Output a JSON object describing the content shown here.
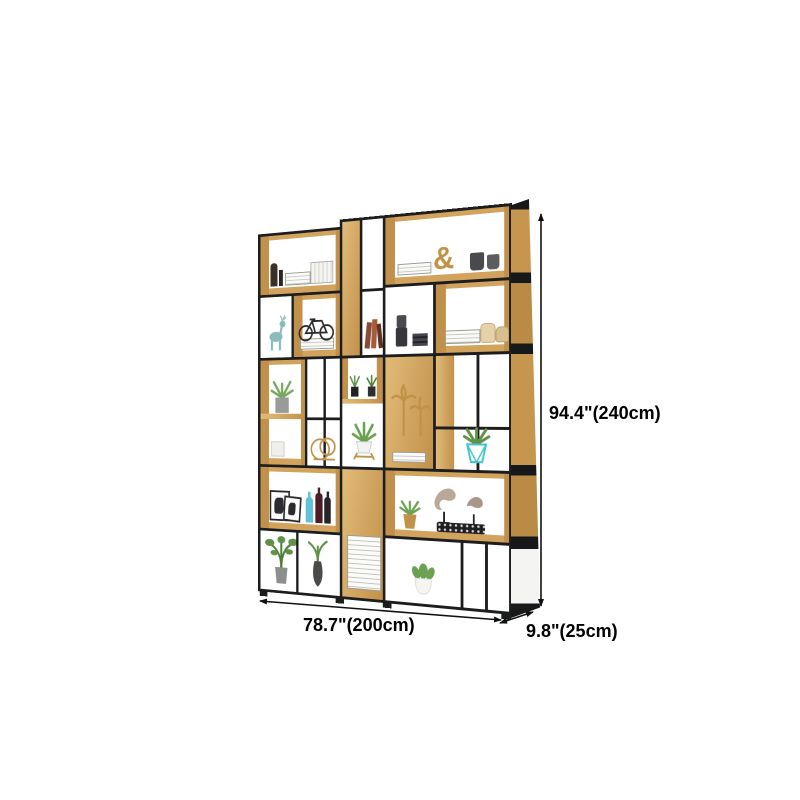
{
  "canvas": {
    "background": "#ffffff"
  },
  "annotations": {
    "height_label": "94.4\"(240cm)",
    "width_label": "78.7\"(200cm)",
    "depth_label": "9.8\"(25cm)",
    "text_color": "#000000",
    "line_color": "#111111"
  },
  "product": {
    "kind": "metal-and-wood etagere display bookshelf",
    "frame_color": "#1c1d1f",
    "wood_color": "#d2a35c",
    "decor": [
      "dark-figurines",
      "white-book-stack",
      "upright-white-books",
      "ampersand-ornament",
      "dark-cups",
      "teal-deer-figurine",
      "bicycle-model",
      "red-books",
      "dark-canisters",
      "cream-vases",
      "magazine-stack",
      "grey-pot-succulent",
      "gold-wire-rings",
      "mini-potted-plants",
      "aloe-plant-white-pot",
      "gold-palm-ornaments",
      "teal-geometric-pot-plant",
      "picture-frames",
      "blue-bottle",
      "wine-bottles",
      "gold-pot-succulent",
      "driftwood-art",
      "studded-ornament",
      "monstera-plant",
      "dark-vase-plant",
      "white-pot-succulent"
    ]
  }
}
